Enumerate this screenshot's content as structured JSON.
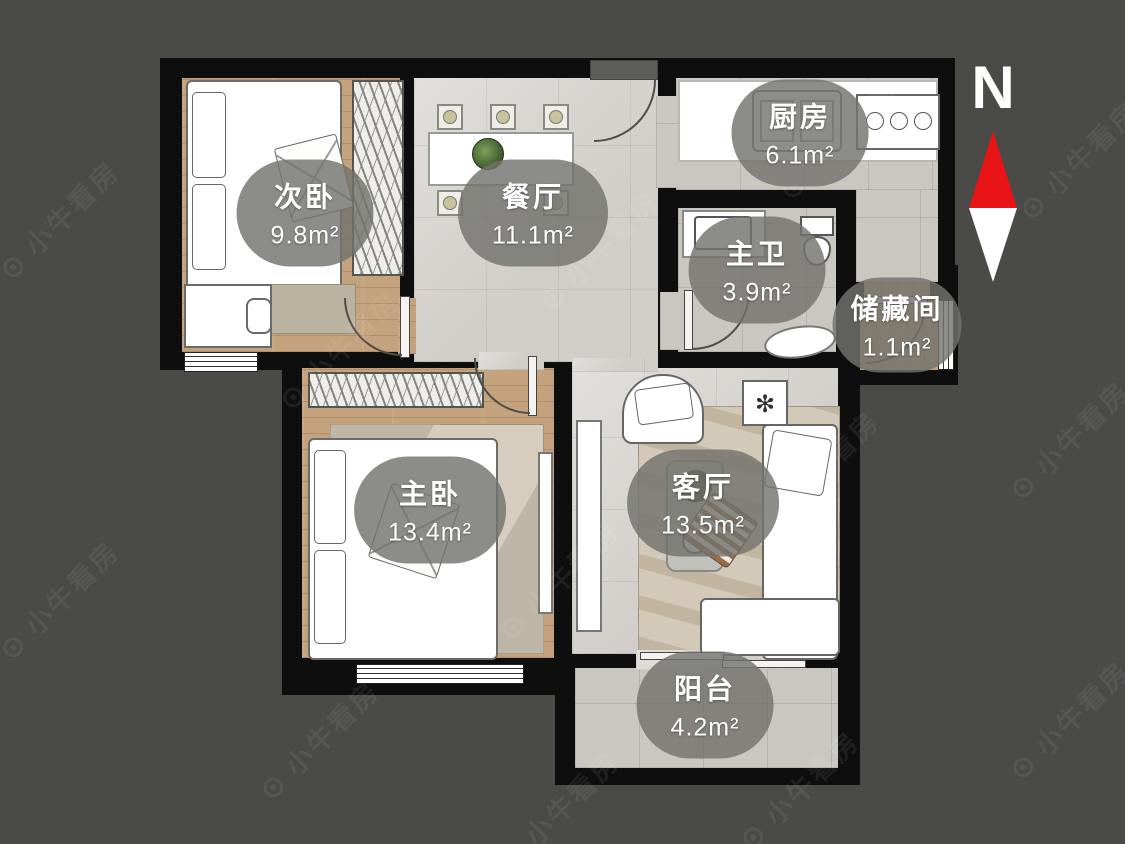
{
  "compass": {
    "label": "N"
  },
  "watermark": {
    "logo": "⊙",
    "text": "小牛看房"
  },
  "rooms": [
    {
      "id": "secondary-bedroom",
      "name": "次卧",
      "area": "9.8m²"
    },
    {
      "id": "dining-room",
      "name": "餐厅",
      "area": "11.1m²"
    },
    {
      "id": "kitchen",
      "name": "厨房",
      "area": "6.1m²"
    },
    {
      "id": "master-bathroom",
      "name": "主卫",
      "area": "3.9m²"
    },
    {
      "id": "storage-room",
      "name": "储藏间",
      "area": "1.1m²"
    },
    {
      "id": "master-bedroom",
      "name": "主卧",
      "area": "13.4m²"
    },
    {
      "id": "living-room",
      "name": "客厅",
      "area": "13.5m²"
    },
    {
      "id": "balcony",
      "name": "阳台",
      "area": "4.2m²"
    }
  ],
  "colors": {
    "bg": "#4a4a47",
    "wall": "#0e0e0e",
    "wood": "#c3a27d",
    "tile-light": "#d8d5d0",
    "tile-gray": "#cac7c1",
    "label-pill": "rgba(115,115,110,0.82)",
    "compass-red": "#e81417"
  }
}
